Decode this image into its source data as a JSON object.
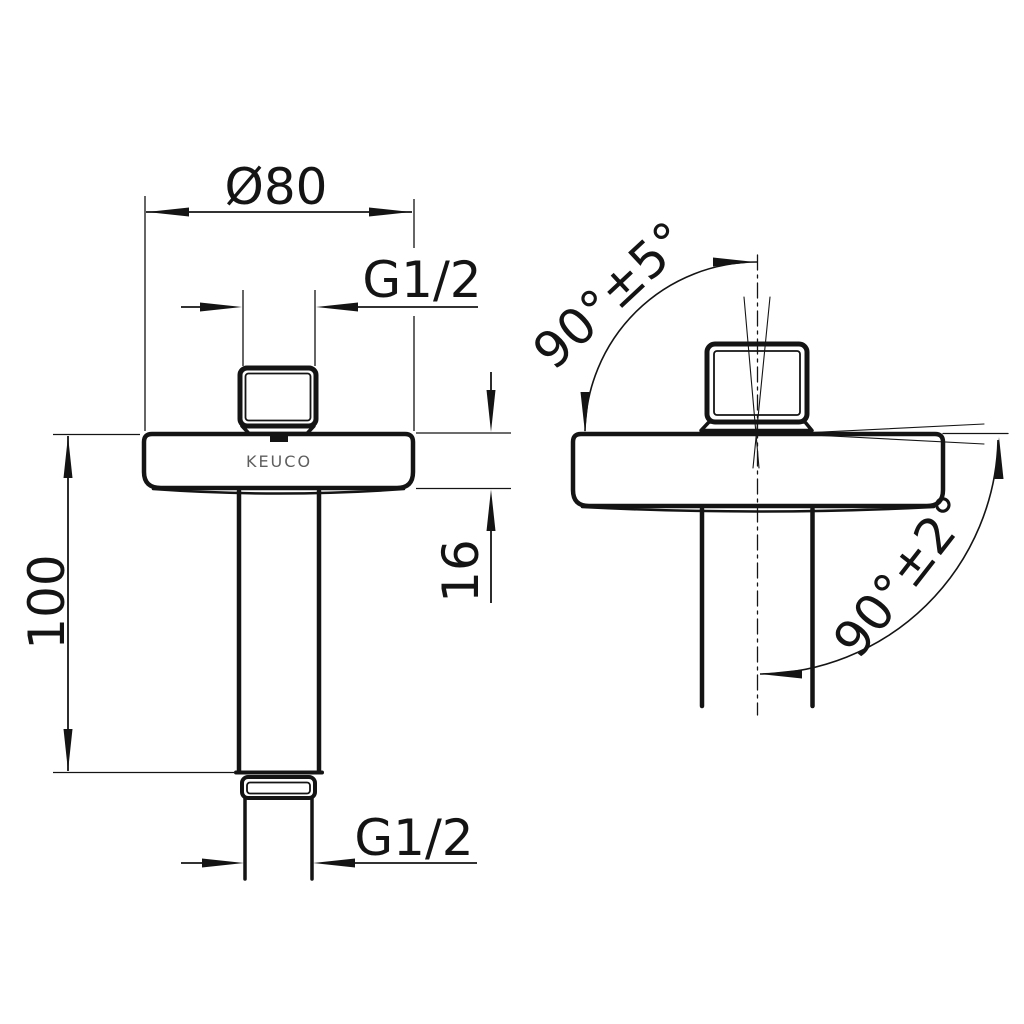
{
  "drawing": {
    "brand_logo": "KEUCO",
    "front_view": {
      "flange_diameter": "Ø80",
      "thread_top": "G1/2",
      "length": "100",
      "flange_height": "16",
      "thread_bottom": "G1/2"
    },
    "side_view": {
      "nut_angle_tolerance": "90°±5°",
      "pipe_angle_tolerance": "90°±2°"
    },
    "colors": {
      "line": "#141414",
      "logo": "#5f5f5f",
      "background": "#ffffff"
    }
  }
}
